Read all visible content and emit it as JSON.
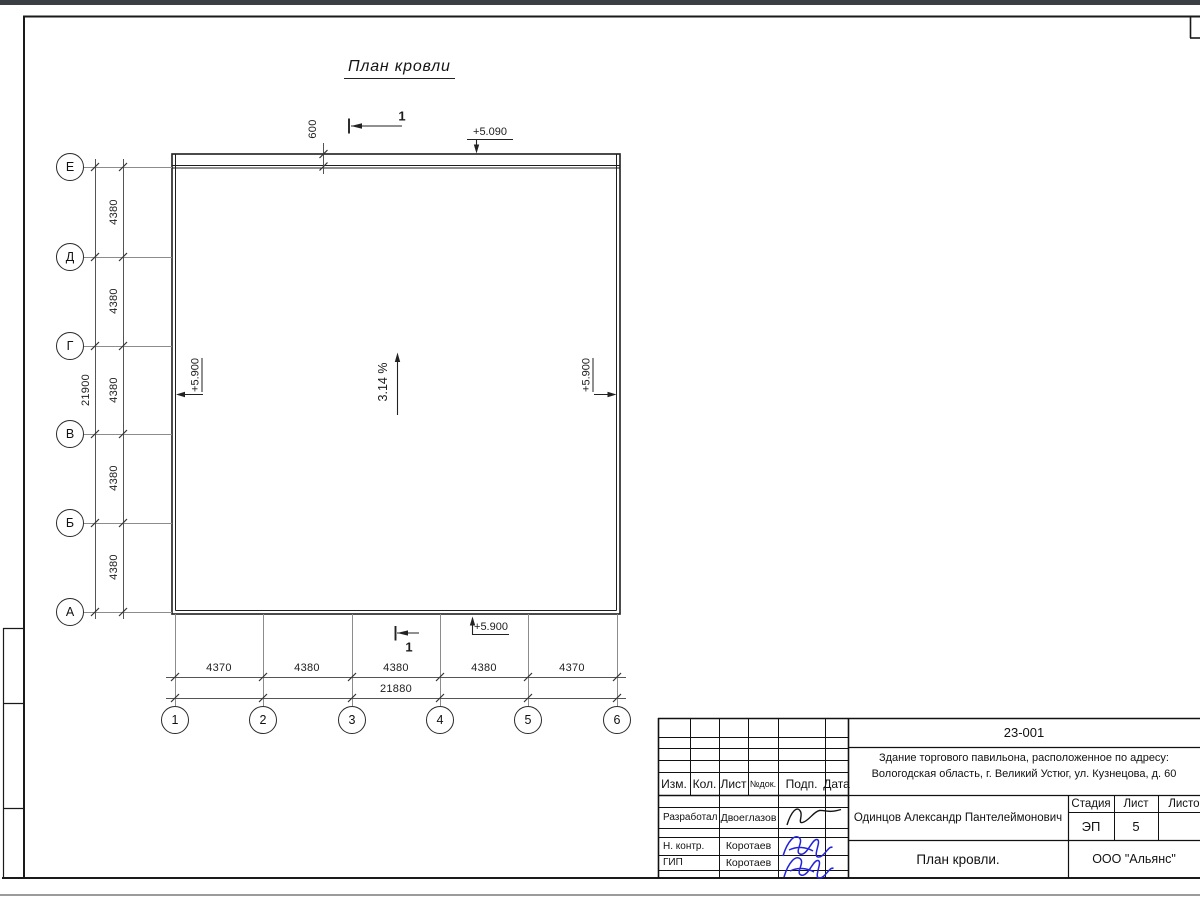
{
  "drawing": {
    "title": "План кровли",
    "slope": "3.14 %",
    "section_label": "1",
    "overhang": "600",
    "elevations": {
      "top": "+5.090",
      "bottom": "+5.900",
      "left": "+5.900",
      "right": "+5.900"
    },
    "axes": {
      "rows": [
        "Е",
        "Д",
        "Г",
        "В",
        "Б",
        "А"
      ],
      "cols": [
        "1",
        "2",
        "3",
        "4",
        "5",
        "6"
      ]
    },
    "dims": {
      "left_intervals": [
        "4380",
        "4380",
        "4380",
        "4380",
        "4380"
      ],
      "left_total": "21900",
      "bottom_intervals": [
        "4370",
        "4380",
        "4380",
        "4380",
        "4370"
      ],
      "bottom_total": "21880"
    }
  },
  "title_block": {
    "doc_number": "23-001",
    "object_address_line1": "Здание торгового павильона, расположенное по адресу:",
    "object_address_line2": "Вологодская область, г. Великий Устюг, ул. Кузнецова, д. 60",
    "chief_name": "Одинцов Александр Пантелеймонович",
    "labels": {
      "izm": "Изм.",
      "kol": "Кол.",
      "list": "Лист",
      "ndok": "№док.",
      "podp": "Подп.",
      "data": "Дата",
      "stage": "Стадия",
      "sheet": "Лист",
      "sheets": "Листов"
    },
    "stage_value": "ЭП",
    "sheet_value": "5",
    "rows": [
      {
        "role": "Разработал",
        "name": "Двоеглазов"
      },
      {
        "role": "Н. контр.",
        "name": "Коротаев"
      },
      {
        "role": "ГИП",
        "name": "Коротаев"
      }
    ],
    "sheet_title": "План кровли.",
    "company": "ООО \"Альянс\""
  }
}
